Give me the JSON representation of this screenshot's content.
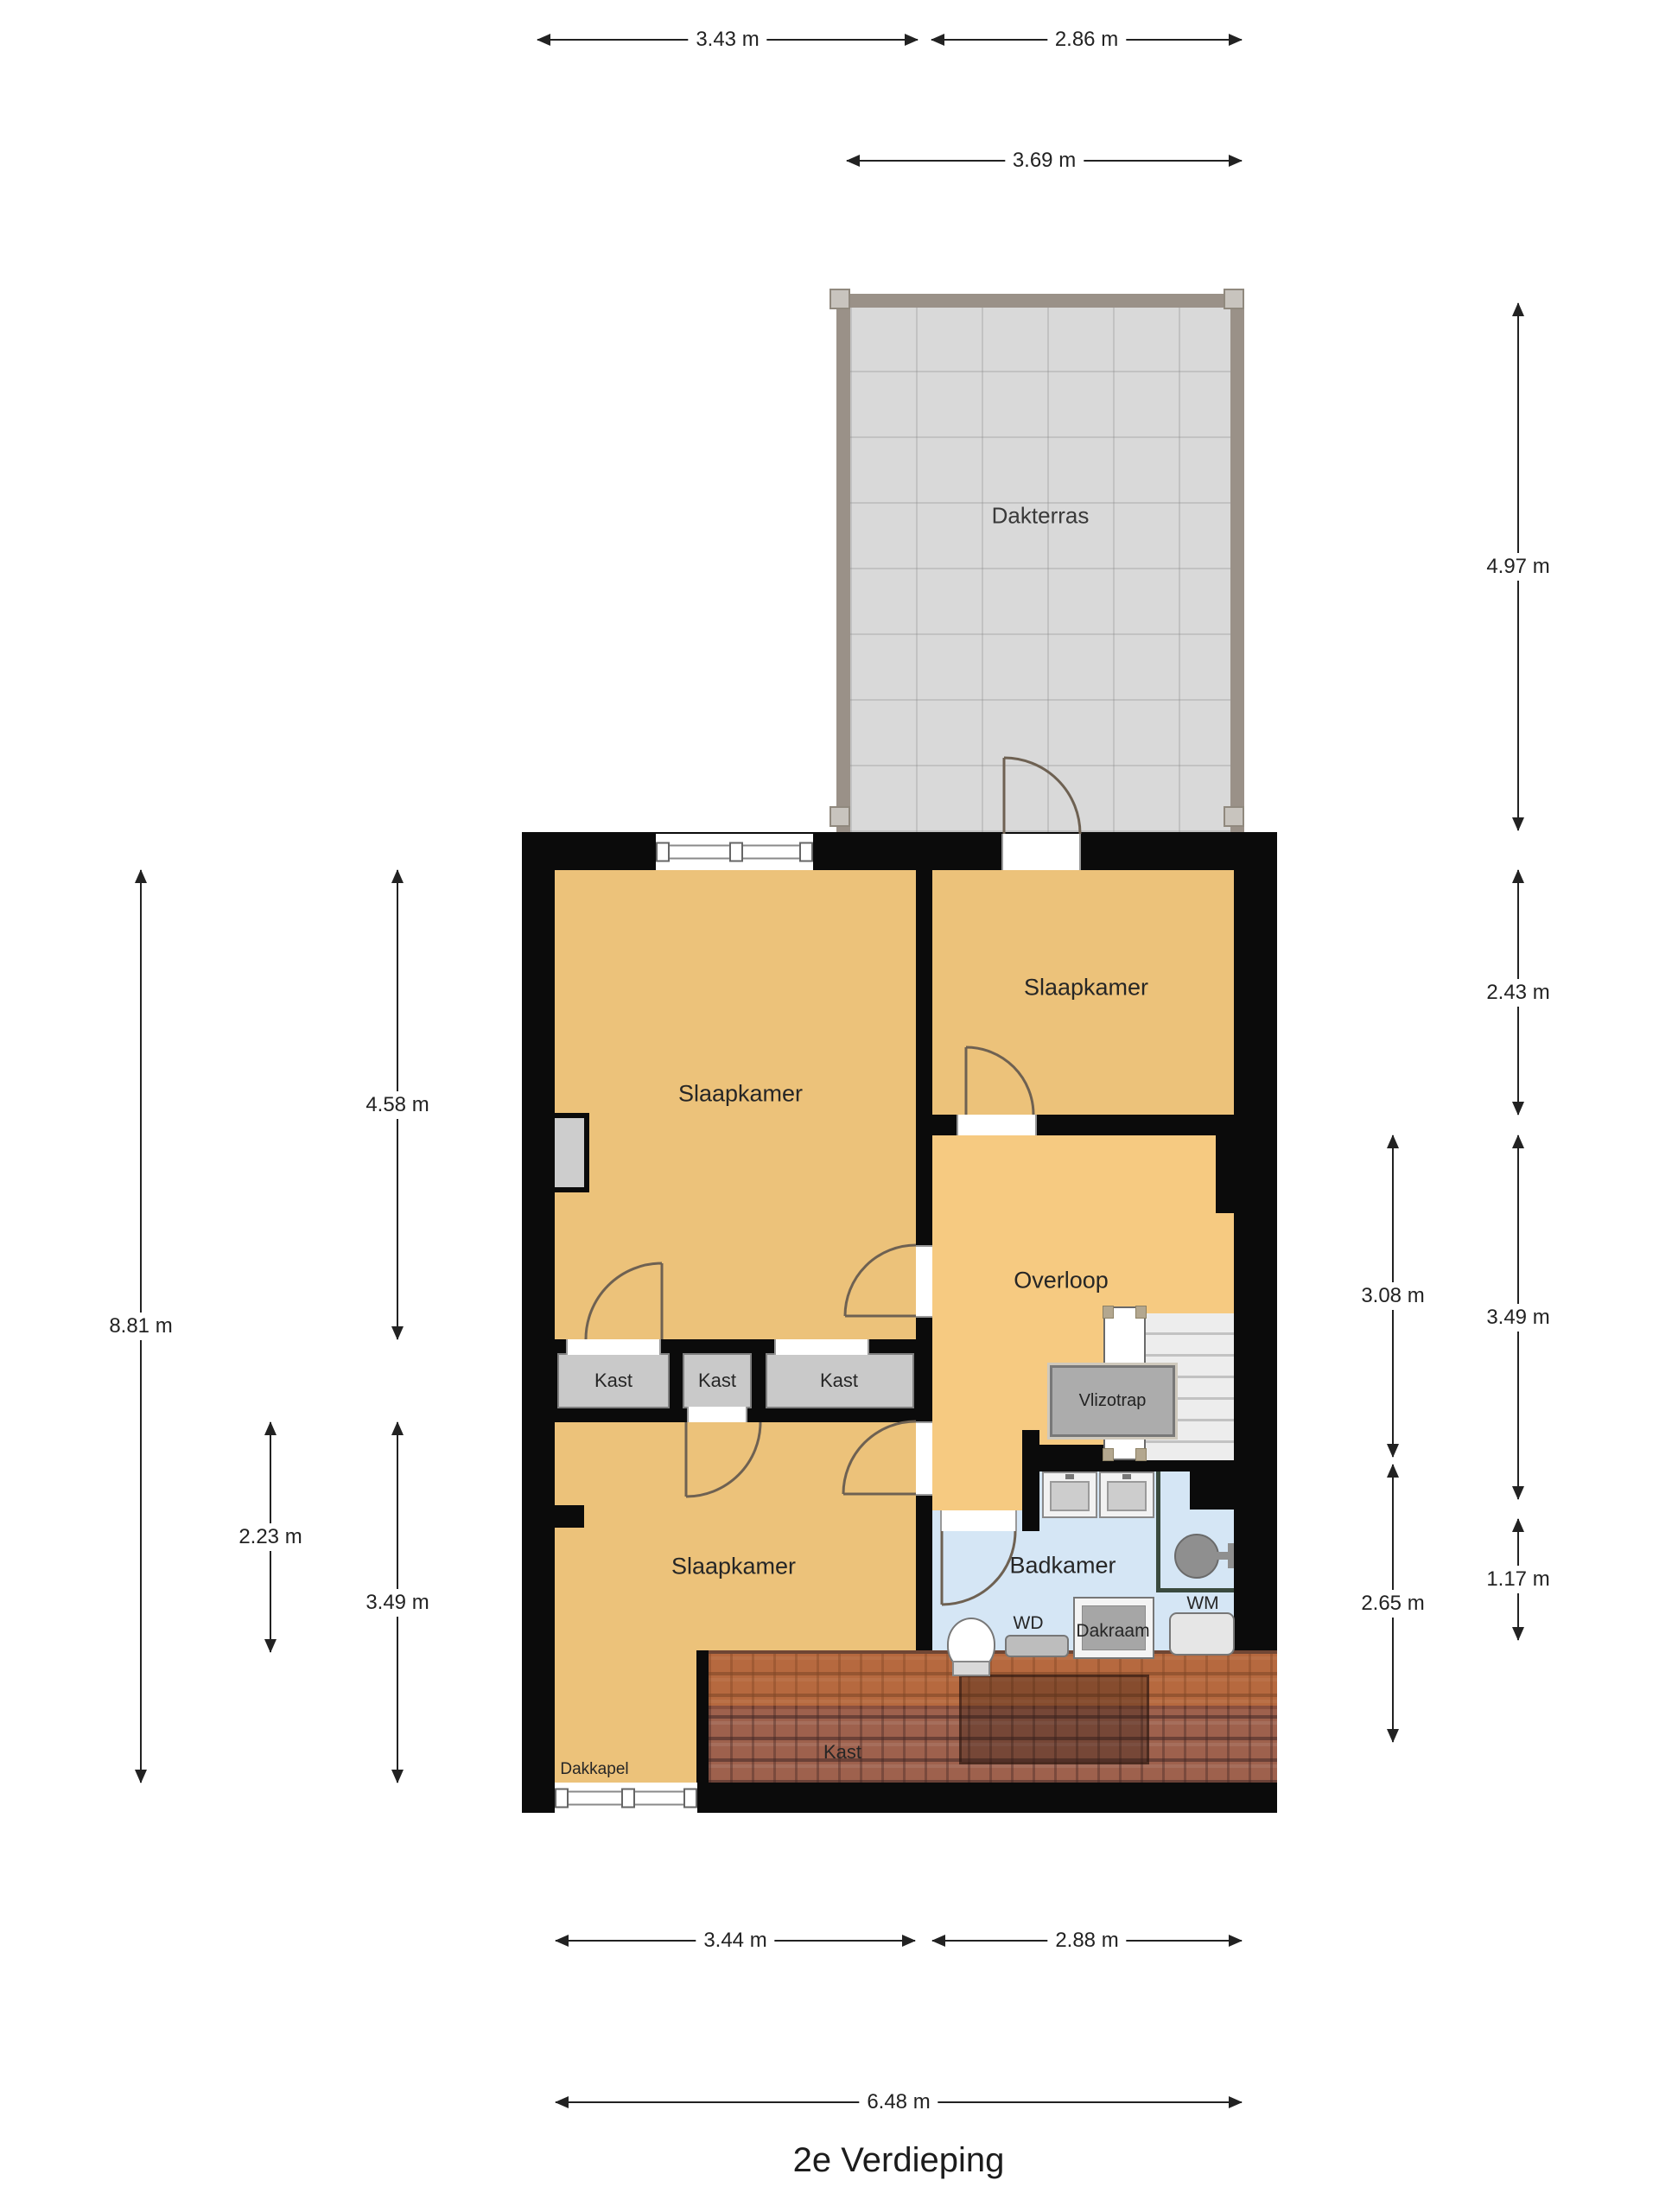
{
  "title": "2e Verdieping",
  "colors": {
    "wall": "#0b0b0b",
    "room": "#ecc27a",
    "hall": "#f6ca81",
    "bath": "#d5e6f5",
    "closet": "#c9c9c9",
    "terrace": "#d9d9d9",
    "rail": "#9a9188",
    "dim": "#222222"
  },
  "rooms": {
    "dakterras": {
      "label": "Dakterras"
    },
    "slaapkamer_tl": {
      "label": "Slaapkamer"
    },
    "slaapkamer_tr": {
      "label": "Slaapkamer"
    },
    "slaapkamer_bottom": {
      "label": "Slaapkamer"
    },
    "overloop": {
      "label": "Overloop"
    },
    "badkamer": {
      "label": "Badkamer"
    },
    "kast_1": {
      "label": "Kast"
    },
    "kast_2": {
      "label": "Kast"
    },
    "kast_3": {
      "label": "Kast"
    },
    "kast_roof": {
      "label": "Kast"
    },
    "vlizotrap": {
      "label": "Vlizotrap"
    },
    "dakkapel": {
      "label": "Dakkapel"
    }
  },
  "fixtures": {
    "wd": "WD",
    "wm": "WM",
    "dakraam": "Dakraam"
  },
  "dimensions": {
    "top": [
      {
        "label": "3.43 m",
        "value_m": 3.43
      },
      {
        "label": "2.86 m",
        "value_m": 2.86
      },
      {
        "label": "3.69 m",
        "value_m": 3.69
      }
    ],
    "bottom": [
      {
        "label": "3.44 m",
        "value_m": 3.44
      },
      {
        "label": "2.88 m",
        "value_m": 2.88
      },
      {
        "label": "6.48 m",
        "value_m": 6.48
      }
    ],
    "left": [
      {
        "label": "8.81 m",
        "value_m": 8.81
      },
      {
        "label": "4.58 m",
        "value_m": 4.58
      },
      {
        "label": "2.23 m",
        "value_m": 2.23
      },
      {
        "label": "3.49 m",
        "value_m": 3.49
      }
    ],
    "right": [
      {
        "label": "4.97 m",
        "value_m": 4.97
      },
      {
        "label": "2.43 m",
        "value_m": 2.43
      },
      {
        "label": "3.08 m",
        "value_m": 3.08
      },
      {
        "label": "3.49 m",
        "value_m": 3.49
      },
      {
        "label": "2.65 m",
        "value_m": 2.65
      },
      {
        "label": "1.17 m",
        "value_m": 1.17
      }
    ]
  }
}
